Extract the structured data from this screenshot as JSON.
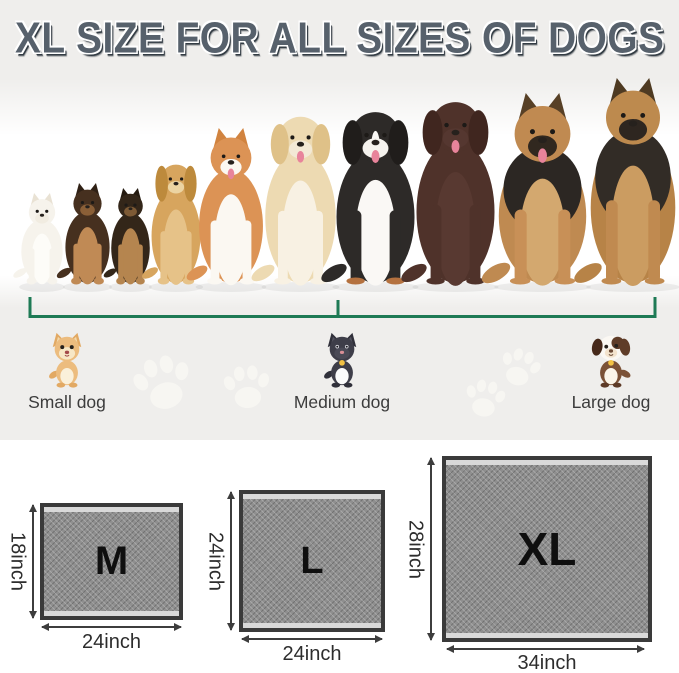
{
  "title": "XL SIZE FOR ALL SIZES OF DOGS",
  "size_groups": [
    {
      "label": "Small dog",
      "icon": "small-dog-icon"
    },
    {
      "label": "Medium dog",
      "icon": "medium-dog-icon"
    },
    {
      "label": "Large dog",
      "icon": "large-dog-icon"
    }
  ],
  "pads": [
    {
      "size": "M",
      "height_label": "18inch",
      "width_label": "24inch"
    },
    {
      "size": "L",
      "height_label": "24inch",
      "width_label": "24inch"
    },
    {
      "size": "XL",
      "height_label": "28inch",
      "width_label": "34inch"
    }
  ],
  "illustration": {
    "dog_lineup_icons": [
      "white-puppy",
      "shepherd-puppy",
      "shepherd-puppy-small",
      "cocker-spaniel",
      "corgi",
      "golden-retriever",
      "bernese-mountain-dog",
      "chocolate-labrador",
      "german-shepherd",
      "german-shepherd-large"
    ],
    "paw_print_count": 4
  },
  "colors": {
    "accent-green": "#1e7a55",
    "title-fill": "#57616c",
    "title-shadow": "#333c44",
    "page-bg": "#efeeec",
    "panel-bg": "#ffffff",
    "pad-frame": "#3a3a3a",
    "pad-fill": "#8f8f8f",
    "pad-strip": "#d9d9d9",
    "dim-line": "#3d3d3d",
    "text-dark": "#3c3c3c"
  }
}
